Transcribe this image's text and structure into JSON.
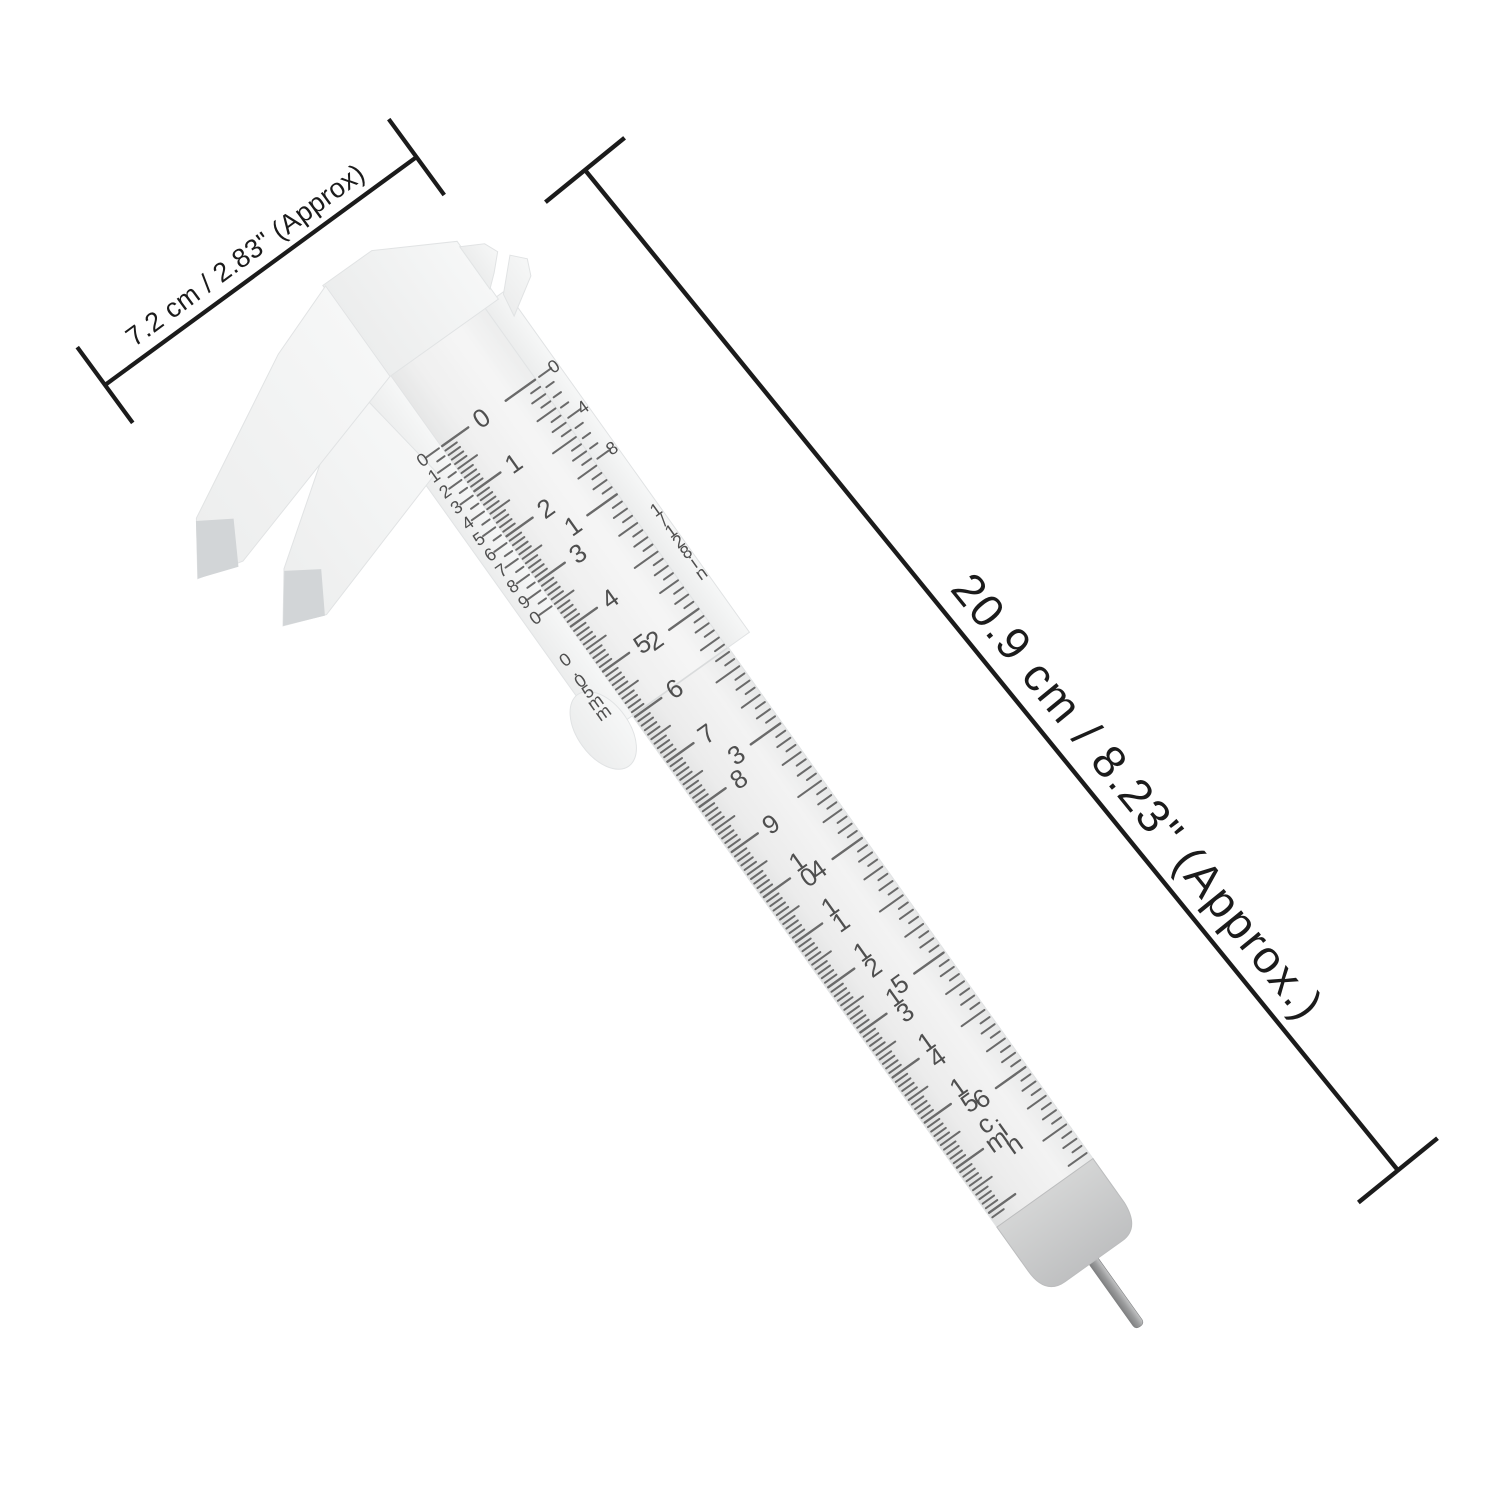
{
  "dimensions": {
    "width_label": "7.2 cm / 2.83\" (Approx)",
    "length_label": "20.9 cm / 8.23\" (Approx.)"
  },
  "caliper": {
    "cm_scale": {
      "labels": [
        "0",
        "1",
        "2",
        "3",
        "4",
        "5",
        "6",
        "7",
        "8",
        "9",
        "10",
        "11",
        "12",
        "13",
        "14",
        "15"
      ],
      "unit": "cm"
    },
    "inch_scale": {
      "labels": [
        "1",
        "2",
        "3",
        "4",
        "5",
        "6"
      ],
      "unit": "in"
    },
    "mm_vernier": {
      "labels": [
        "0",
        "1",
        "2",
        "3",
        "4",
        "5",
        "6",
        "7",
        "8",
        "9",
        "0"
      ],
      "precision_label": "0.05mm"
    },
    "inch_vernier": {
      "labels": [
        "0",
        "4",
        "8"
      ],
      "precision_label": "1/128in"
    },
    "colors": {
      "annotation": "#1b1b1b",
      "tick": "#6a6a6a",
      "scale_text": "#4f4f4f",
      "body": "#f3f4f4",
      "beam": "#ededed",
      "end_cap": "#c7c8c9",
      "pin": "#9a9a9a"
    }
  }
}
